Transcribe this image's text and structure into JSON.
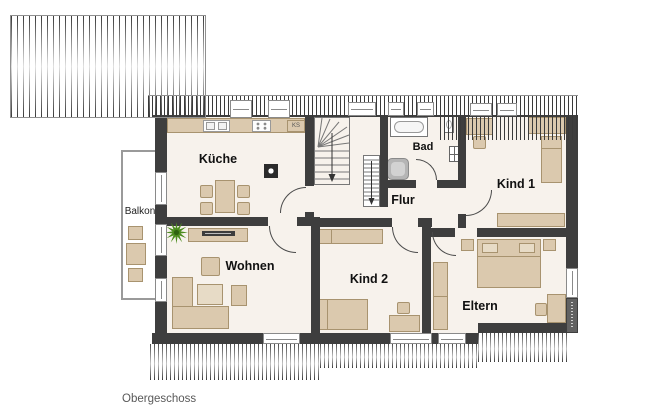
{
  "floor": {
    "name": "Obergeschoss"
  },
  "rooms": {
    "kueche": "Küche",
    "balkon": "Balkon",
    "wohnen": "Wohnen",
    "flur": "Flur",
    "bad": "Bad",
    "kind1": "Kind 1",
    "kind2": "Kind 2",
    "eltern": "Eltern"
  },
  "kitchen": {
    "fridge_label": "KS"
  },
  "colors": {
    "wall": "#3e3e3e",
    "floor": "#f7f2ec",
    "furniture": "#dbc9ae",
    "furniture_border": "#a8936f",
    "hatch_line": "#3a3a3a",
    "window_frame": "#8a8a8a",
    "door_arc": "#4a4a4a",
    "plant": "#4c8c1e",
    "label_text": "#111111",
    "muted_text": "#595959"
  }
}
